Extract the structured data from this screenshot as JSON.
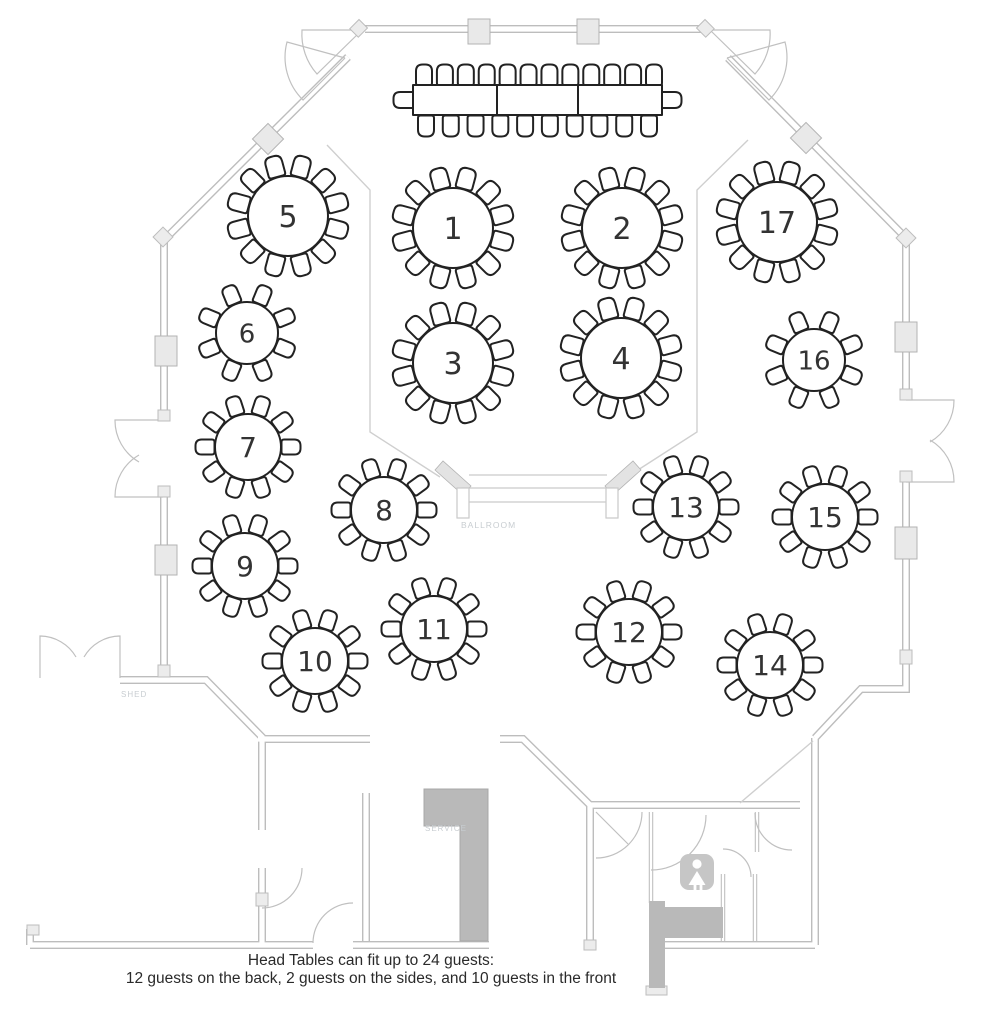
{
  "floor_plan": {
    "caption": {
      "line1": "Head Tables can fit up to 24 guests:",
      "line2": "12 guests on the back, 2 guests on the sides, and 10 guests in the front"
    },
    "area_labels": {
      "ballroom": "BALLROOM",
      "shed": "SHED",
      "service": "SERVICE"
    },
    "colors": {
      "wall_line": "#bdbdbd",
      "furniture_line": "#222222",
      "area_label_text": "#c8cdd1",
      "service_fill": "#b9b9b9",
      "pillar_fill": "#e9e9e9",
      "restroom_icon_fill": "#c6c6c6",
      "caption_text": "#2a2a2a"
    },
    "head_table": {
      "sections": 3,
      "capacity": 24,
      "back_seats": 12,
      "side_seats": 2,
      "front_seats": 10
    },
    "tables": [
      {
        "number": "1",
        "x": 453,
        "y": 228,
        "r": 40,
        "seats": 12
      },
      {
        "number": "2",
        "x": 622,
        "y": 228,
        "r": 40,
        "seats": 12
      },
      {
        "number": "3",
        "x": 453,
        "y": 363,
        "r": 40,
        "seats": 12
      },
      {
        "number": "4",
        "x": 621,
        "y": 358,
        "r": 40,
        "seats": 12
      },
      {
        "number": "5",
        "x": 288,
        "y": 216,
        "r": 40,
        "seats": 12
      },
      {
        "number": "6",
        "x": 247,
        "y": 333,
        "r": 31,
        "seats": 8
      },
      {
        "number": "7",
        "x": 248,
        "y": 447,
        "r": 33,
        "seats": 10
      },
      {
        "number": "8",
        "x": 384,
        "y": 510,
        "r": 33,
        "seats": 10
      },
      {
        "number": "9",
        "x": 245,
        "y": 566,
        "r": 33,
        "seats": 10
      },
      {
        "number": "10",
        "x": 315,
        "y": 661,
        "r": 33,
        "seats": 10
      },
      {
        "number": "11",
        "x": 434,
        "y": 629,
        "r": 33,
        "seats": 10
      },
      {
        "number": "12",
        "x": 629,
        "y": 632,
        "r": 33,
        "seats": 10
      },
      {
        "number": "13",
        "x": 686,
        "y": 507,
        "r": 33,
        "seats": 10
      },
      {
        "number": "14",
        "x": 770,
        "y": 665,
        "r": 33,
        "seats": 10
      },
      {
        "number": "15",
        "x": 825,
        "y": 517,
        "r": 33,
        "seats": 10
      },
      {
        "number": "16",
        "x": 814,
        "y": 360,
        "r": 31,
        "seats": 8
      },
      {
        "number": "17",
        "x": 777,
        "y": 222,
        "r": 40,
        "seats": 12
      }
    ]
  }
}
